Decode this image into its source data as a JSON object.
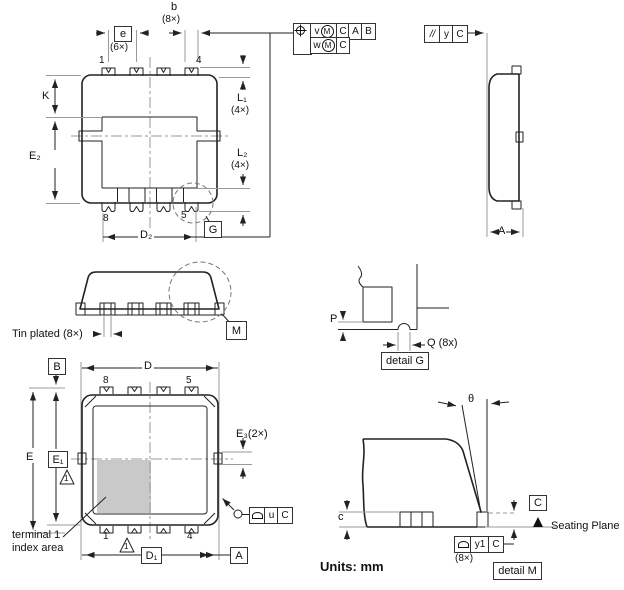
{
  "units_label": "Units: mm",
  "tolerances": {
    "position": {
      "symbol_icon": "position-icon",
      "row1_char": "v",
      "row1_mod": "M",
      "row1_datums": [
        "C",
        "A",
        "B"
      ],
      "row2_char": "w",
      "row2_mod": "M",
      "row2_datum": "C"
    },
    "parallelism": {
      "symbol": "//",
      "tolerance": "y",
      "datum": "C"
    }
  },
  "bottom_view": {
    "dim_b": "b",
    "dim_b_count": "(8×)",
    "dim_e": "e",
    "dim_e_count": "(6×)",
    "pin1": "1",
    "pin4": "4",
    "pin8": "8",
    "pin5": "5",
    "dim_K": "K",
    "dim_E2": "E₂",
    "dim_L1": "L₁",
    "dim_L1_count": "(4×)",
    "dim_L2": "L₂",
    "dim_L2_count": "(4×)",
    "dim_D2": "D₂",
    "detail_g_ref": "G"
  },
  "side_view_right": {
    "dim_A": "A"
  },
  "side_view_front": {
    "tin_plated": "Tin plated (8×)",
    "detail_m_ref": "M"
  },
  "detail_g": {
    "dim_P": "P",
    "dim_Q": "Q (8x)",
    "caption": "detail G"
  },
  "top_view": {
    "datum_B": "B",
    "datum_A": "A",
    "dim_D": "D",
    "dim_D1": "D₁",
    "dim_E": "E",
    "dim_E1": "E₁",
    "dim_E3": "E₃(2×)",
    "pin8": "8",
    "pin5": "5",
    "pin1": "1",
    "pin4": "4",
    "note_flag": "1",
    "index_line1": "terminal 1",
    "index_line2": "index area",
    "frame_u": {
      "symbol_icon": "profile-icon",
      "tolerance": "u",
      "datum": "C"
    }
  },
  "detail_m": {
    "angle": "θ",
    "dim_c": "c",
    "datum_C": "C",
    "seating_plane": "Seating Plane",
    "frame_y1": {
      "symbol_icon": "profile-icon",
      "tolerance": "y1",
      "datum": "C"
    },
    "count": "(8×)",
    "caption": "detail M"
  }
}
